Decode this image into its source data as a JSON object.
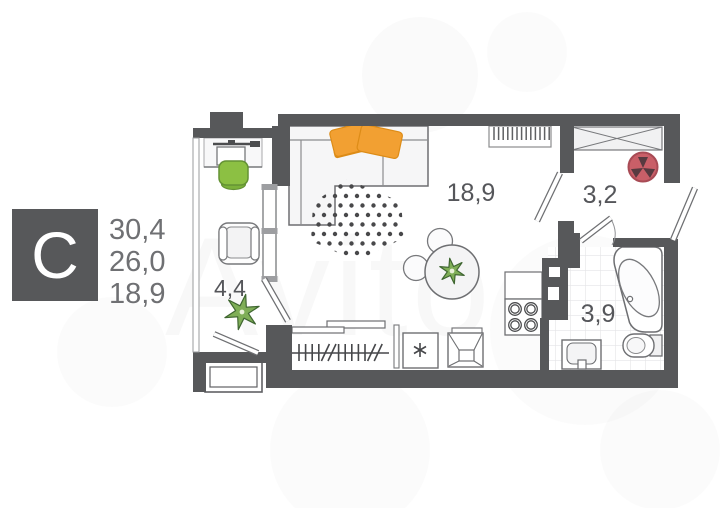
{
  "watermark": "Avito",
  "legend": {
    "type_letter": "С",
    "area_total": "30,4",
    "area_living": "26,0",
    "area_room": "18,9"
  },
  "rooms": {
    "living": "18,9",
    "hall": "3,2",
    "bathroom": "3,9",
    "balcony": "4,4"
  },
  "colors": {
    "wall": "#57585a",
    "outline": "#6e6f72",
    "fill_light": "#f4f4f5",
    "accent_orange": "#f2a032",
    "accent_orange_dark": "#dd8c17",
    "accent_green": "#8cc043",
    "accent_green_dark": "#649234",
    "plant_green": "#7fae57",
    "vent_red": "#c95f68",
    "vent_red_dark": "#a84b55",
    "label_gray": "#55565a",
    "legend_num_gray": "#6f7073",
    "tile_gray": "#e4e4e6"
  },
  "decor": {
    "rug": {
      "x0": 302,
      "y0": 177,
      "dx": 11,
      "dy": 9.5,
      "cols": 10,
      "rows": 10,
      "dot_r": 2.2
    },
    "hanger": {
      "x0": 299,
      "step": 6.6,
      "pattern": [
        "|",
        "|",
        "|",
        "|",
        "/",
        "/",
        "|",
        "|",
        "|",
        "|",
        "|",
        "/",
        "/"
      ],
      "y_top": 344,
      "y_bot": 361
    },
    "radiator_teeth": {
      "x0": 494,
      "step": 4.6,
      "count": 13,
      "y_top": 127,
      "y_bot": 140
    },
    "plants": [
      {
        "cx": 242,
        "cy": 312,
        "r_out": 18,
        "r_in": 6.5,
        "points": 6,
        "rot": 12
      },
      {
        "cx": 452,
        "cy": 271,
        "r_out": 13,
        "r_in": 4.8,
        "points": 6,
        "rot": -10
      }
    ]
  }
}
